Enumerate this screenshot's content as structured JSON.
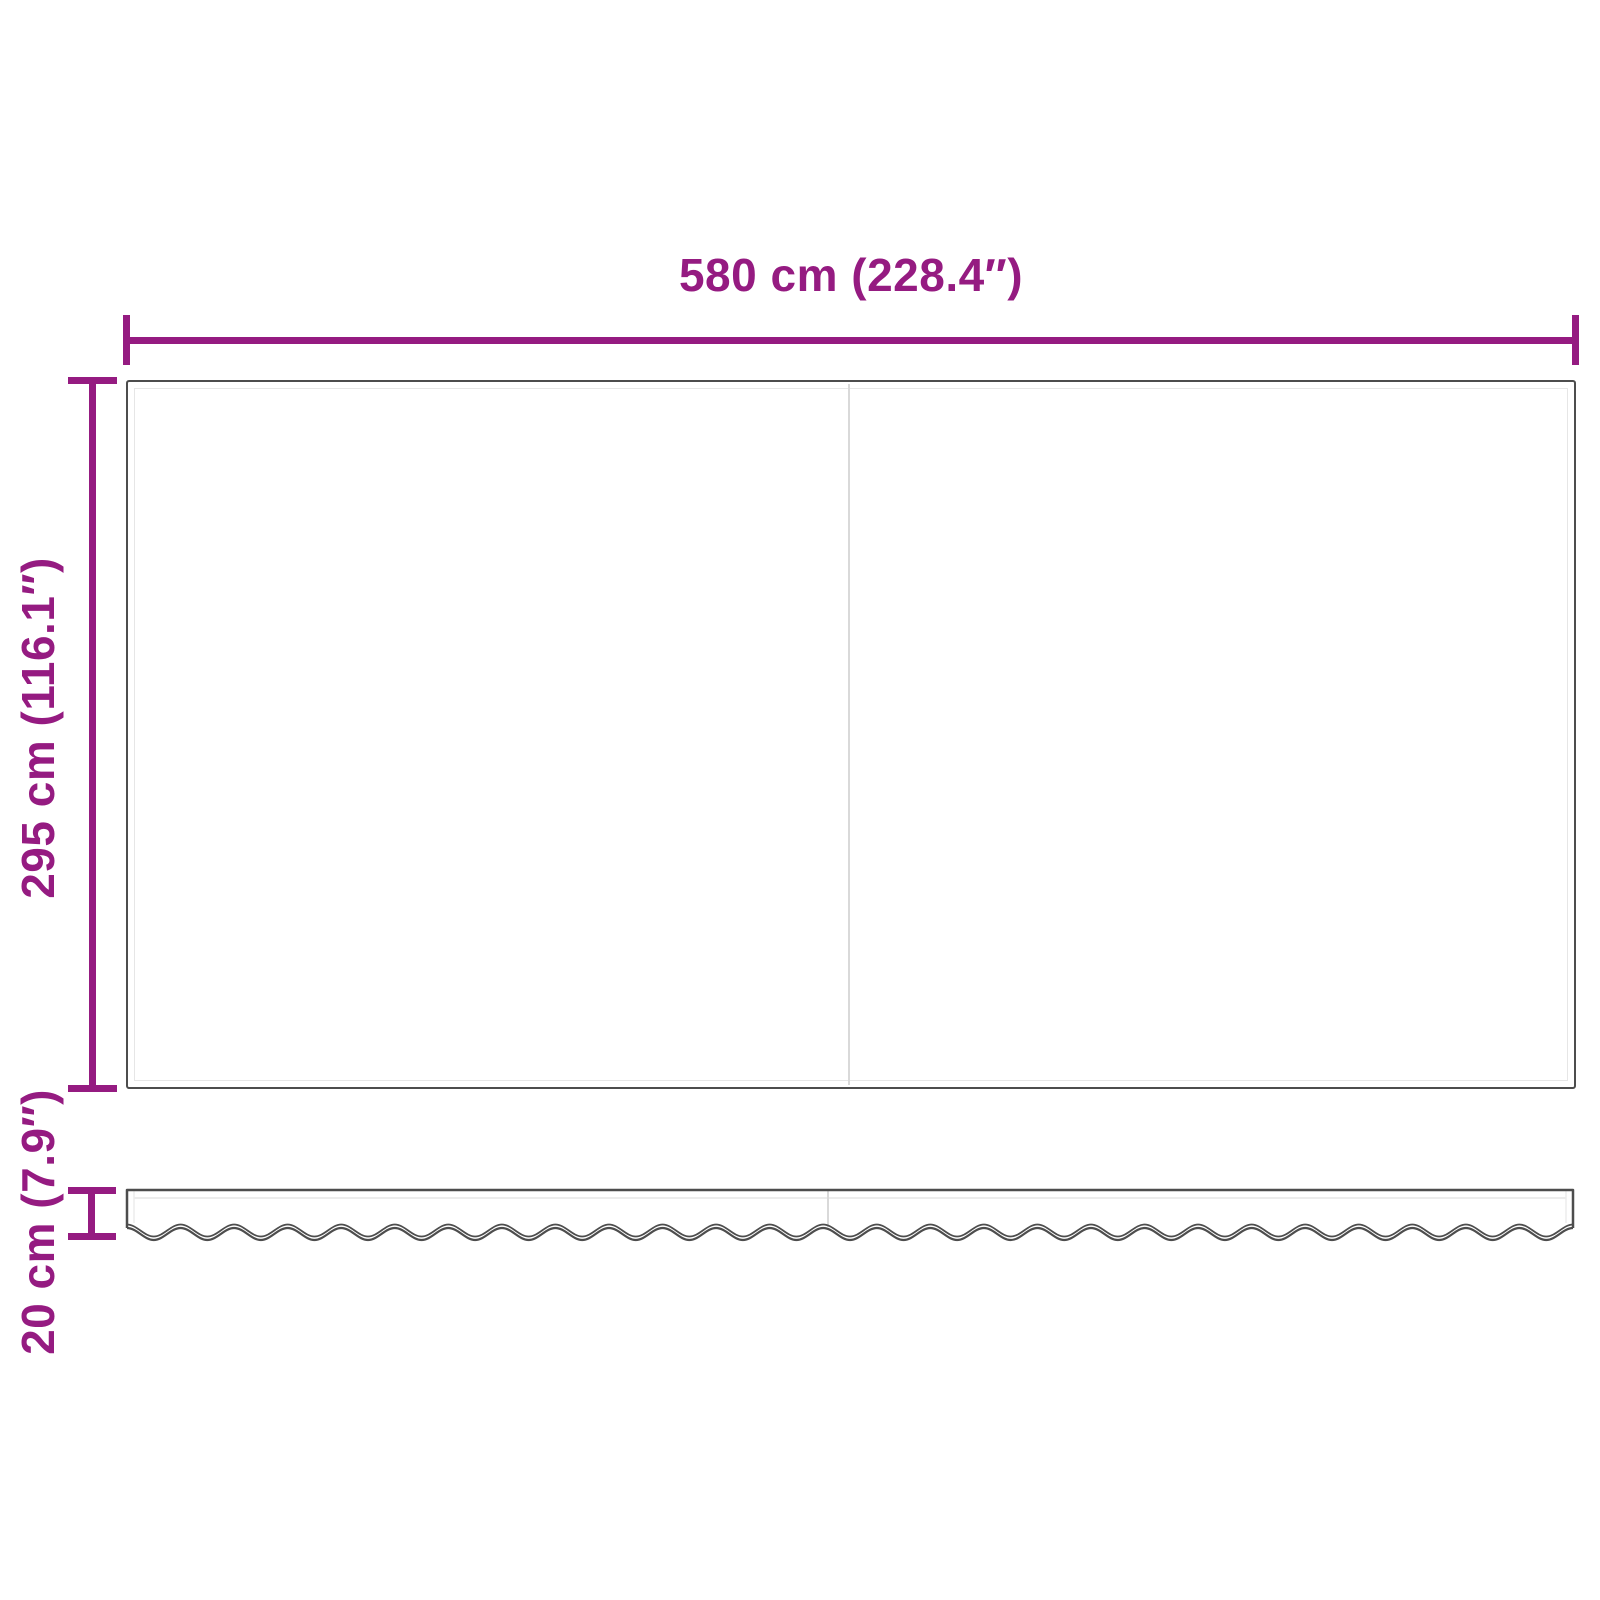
{
  "diagram": {
    "title": "awning-fabric-dimension-diagram",
    "dimensions": {
      "width": {
        "label": "580 cm (228.4″)",
        "orientation": "horizontal"
      },
      "height": {
        "label": "295 cm (116.1″)",
        "orientation": "vertical"
      },
      "valance_height": {
        "label": "20 cm (7.9″)",
        "orientation": "vertical"
      }
    },
    "parts": {
      "main_panel": "awning-fabric-panel",
      "valance": "wavy-valance-strip",
      "seam": "center-seam-line"
    },
    "colors": {
      "dimension_accent": "#951B81",
      "outline": "#4d4d4d",
      "inner_line": "#e6e6e6",
      "seam": "#d9d9d9",
      "background": "#ffffff"
    }
  }
}
